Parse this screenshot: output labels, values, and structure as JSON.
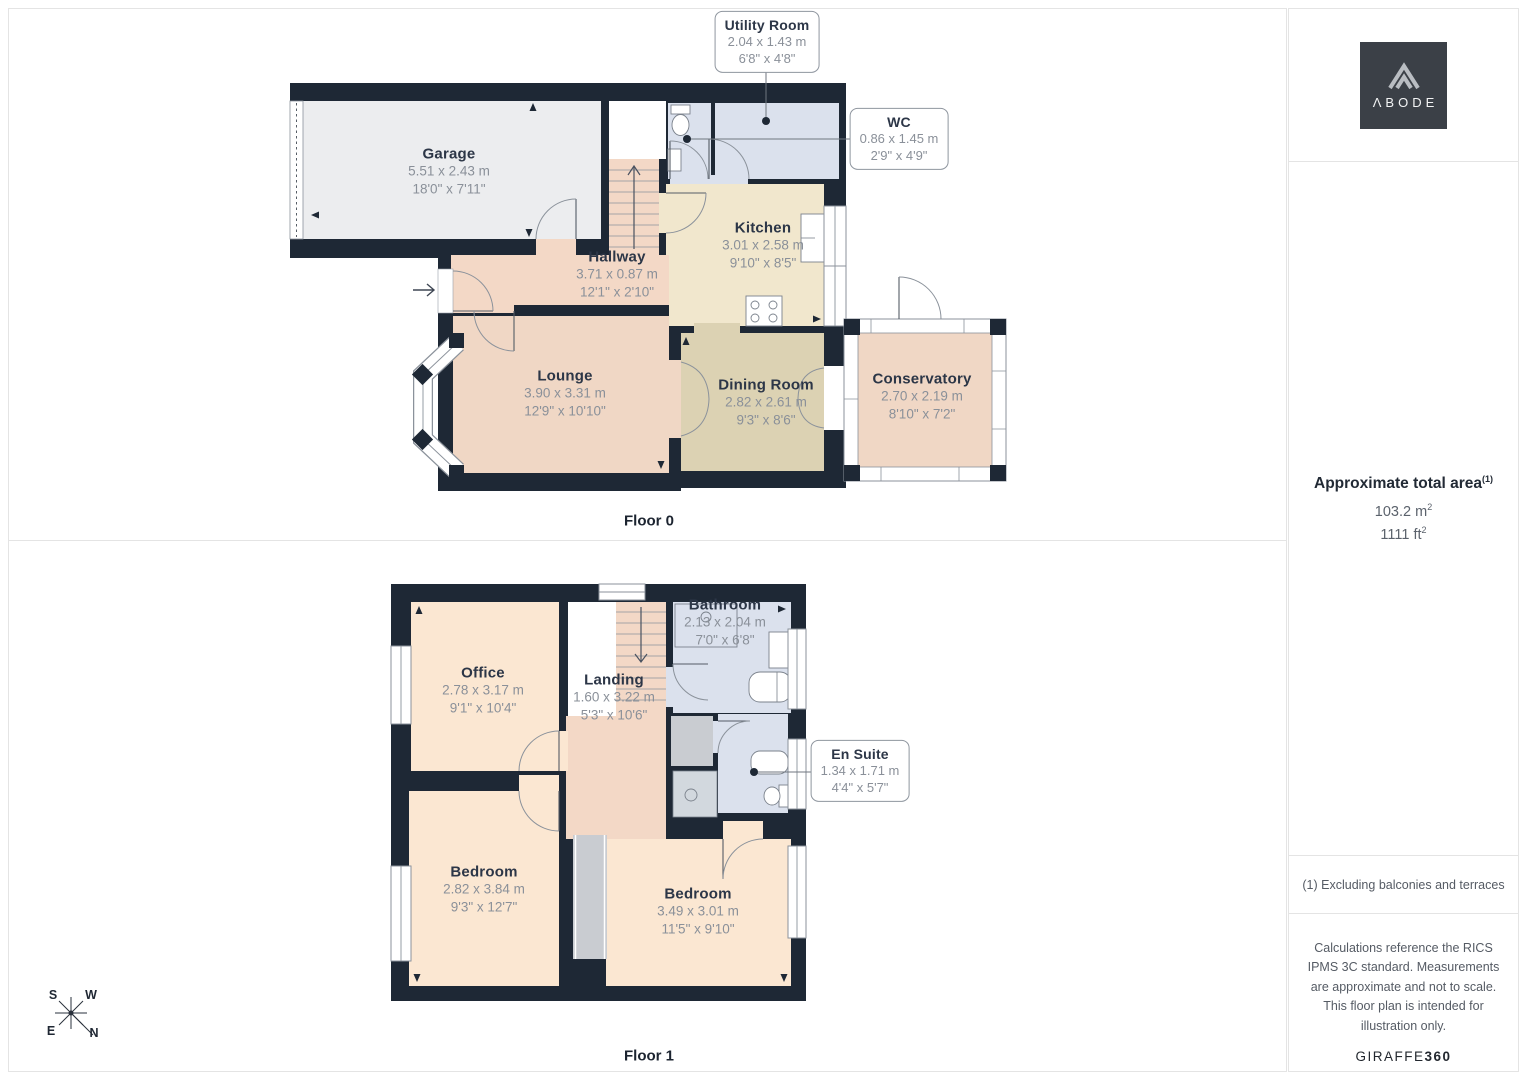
{
  "floor0": {
    "label": "Floor 0",
    "rooms": {
      "garage": {
        "name": "Garage",
        "metric": "5.51 x 2.43 m",
        "imperial": "18'0\" x 7'11\""
      },
      "hallway": {
        "name": "Hallway",
        "metric": "3.71 x 0.87 m",
        "imperial": "12'1\" x 2'10\""
      },
      "kitchen": {
        "name": "Kitchen",
        "metric": "3.01 x 2.58 m",
        "imperial": "9'10\" x 8'5\""
      },
      "utility": {
        "name": "Utility Room",
        "metric": "2.04 x 1.43 m",
        "imperial": "6'8\" x 4'8\""
      },
      "wc": {
        "name": "WC",
        "metric": "0.86 x 1.45 m",
        "imperial": "2'9\" x 4'9\""
      },
      "lounge": {
        "name": "Lounge",
        "metric": "3.90 x 3.31 m",
        "imperial": "12'9\" x 10'10\""
      },
      "dining": {
        "name": "Dining Room",
        "metric": "2.82 x 2.61 m",
        "imperial": "9'3\" x 8'6\""
      },
      "conservatory": {
        "name": "Conservatory",
        "metric": "2.70 x 2.19 m",
        "imperial": "8'10\" x 7'2\""
      }
    }
  },
  "floor1": {
    "label": "Floor 1",
    "rooms": {
      "office": {
        "name": "Office",
        "metric": "2.78 x 3.17 m",
        "imperial": "9'1\" x 10'4\""
      },
      "landing": {
        "name": "Landing",
        "metric": "1.60 x 3.22 m",
        "imperial": "5'3\" x 10'6\""
      },
      "bathroom": {
        "name": "Bathroom",
        "metric": "2.13 x 2.04 m",
        "imperial": "7'0\" x 6'8\""
      },
      "ensuite": {
        "name": "En Suite",
        "metric": "1.34 x 1.71 m",
        "imperial": "4'4\" x 5'7\""
      },
      "bedroom1": {
        "name": "Bedroom",
        "metric": "2.82 x 3.84 m",
        "imperial": "9'3\" x 12'7\""
      },
      "bedroom2": {
        "name": "Bedroom",
        "metric": "3.49 x 3.01 m",
        "imperial": "11'5\" x 9'10\""
      }
    }
  },
  "compass": {
    "n": "N",
    "s": "S",
    "e": "E",
    "w": "W"
  },
  "sidebar": {
    "logo_text": "ΛBODE",
    "area": {
      "title": "Approximate total area",
      "sup": "(1)",
      "metric": "103.2 m",
      "metric_sup": "2",
      "imperial": "1111 ft",
      "imperial_sup": "2"
    },
    "footnote": "(1) Excluding balconies and terraces",
    "disclaimer": "Calculations reference the RICS IPMS 3C standard. Measurements are approximate and not to scale. This floor plan is intended for illustration only.",
    "brand": "GIRAFFE",
    "brand_bold": "360"
  },
  "colors": {
    "wall": "#1e2835",
    "wet_room_floor": "#dbe1ed",
    "kitchen_floor": "#f1e7cd",
    "dining_floor": "#dcd2b3",
    "hall_floor": "#f3d8c6",
    "bedroom_floor": "#fbe7d2",
    "garage_floor": "#ecedef",
    "logo_bg": "#3b4047"
  }
}
